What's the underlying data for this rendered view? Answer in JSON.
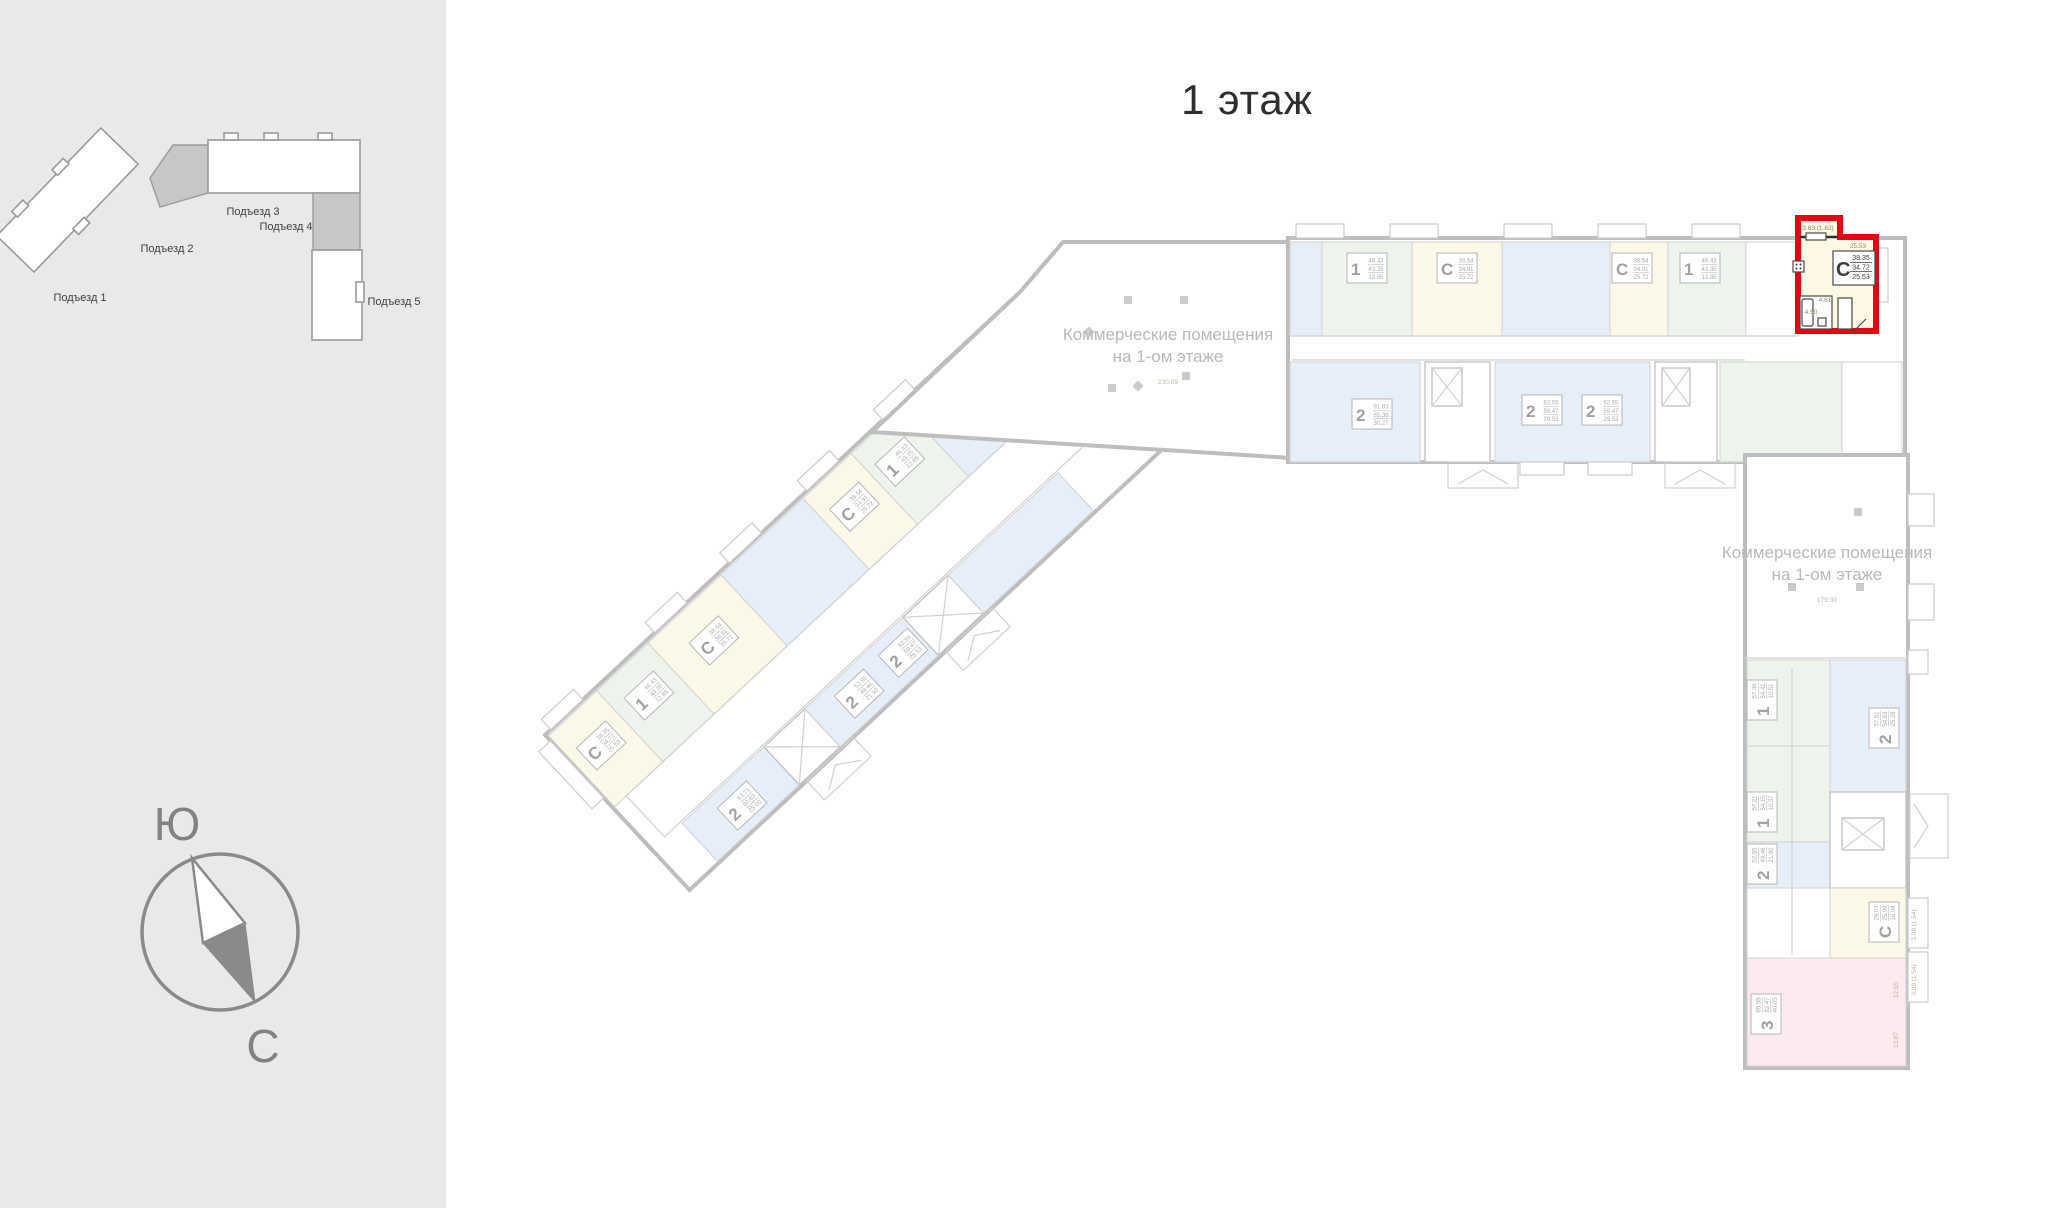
{
  "title": "1 этаж",
  "sidebar": {
    "minimap": {
      "entrances": [
        "Подъезд 1",
        "Подъезд 2",
        "Подъезд 3",
        "Подъезд 4",
        "Подъезд 5"
      ]
    },
    "compass": {
      "south": "Ю",
      "north": "С"
    }
  },
  "plan": {
    "commercial_top": {
      "line1": "Коммерческие помещения",
      "line2": "на 1-ом этаже",
      "area": "230.09"
    },
    "commercial_right": {
      "line1": "Коммерческие помещения",
      "line2": "на 1-ом этаже",
      "area": "179.30"
    },
    "highlighted": {
      "type": "С",
      "total": "38.35",
      "living": "34.72",
      "kitchen": "25.53",
      "balcony": "3.63 (1.82)",
      "room": "25.53",
      "hall": "4.61",
      "bath": "4.50"
    },
    "dims": {
      "v_balcony1": "3.08 (1.54)",
      "v_balcony2": "3.08 (1.54)",
      "pink_room1": "12.95",
      "pink_room2": "13.87"
    },
    "apartments": [
      {
        "type": "1",
        "total": "46.43",
        "living": "43.35",
        "kitchen": "12.85"
      },
      {
        "type": "С",
        "total": "38.54",
        "living": "34.91",
        "kitchen": "25.72"
      },
      {
        "type": "С",
        "total": "38.54",
        "living": "34.91",
        "kitchen": "25.72"
      },
      {
        "type": "1",
        "total": "46.43",
        "living": "43.35",
        "kitchen": "12.85"
      },
      {
        "type": "2",
        "total": "91.83",
        "living": "85.38",
        "kitchen": "30.27"
      },
      {
        "type": "2",
        "total": "62.55",
        "living": "59.47",
        "kitchen": "29.53"
      },
      {
        "type": "2",
        "total": "62.55",
        "living": "59.47",
        "kitchen": "29.53"
      },
      {
        "type": "С",
        "total": "38.35",
        "living": "34.72",
        "kitchen": "25.53"
      },
      {
        "type": "1",
        "total": "46.43",
        "living": "43.35",
        "kitchen": "12.85"
      },
      {
        "type": "С",
        "total": "38.54",
        "living": "34.91",
        "kitchen": "25.72"
      },
      {
        "type": "С",
        "total": "38.54",
        "living": "34.91",
        "kitchen": "25.72"
      },
      {
        "type": "1",
        "total": "46.43",
        "living": "43.35",
        "kitchen": "12.85"
      },
      {
        "type": "2",
        "total": "63.71",
        "living": "60.63",
        "kitchen": "23.00"
      },
      {
        "type": "2",
        "total": "52.55",
        "living": "49.46",
        "kitchen": "21.90"
      },
      {
        "type": "2",
        "total": "62.55",
        "living": "59.47",
        "kitchen": "29.53"
      },
      {
        "type": "1",
        "total": "57.49",
        "living": "54.41",
        "kitchen": "10.51"
      },
      {
        "type": "2",
        "total": "57.51",
        "living": "54.63",
        "kitchen": "25.28"
      },
      {
        "type": "1",
        "total": "57.21",
        "living": "54.15",
        "kitchen": "10.37"
      },
      {
        "type": "2",
        "total": "52.55",
        "living": "49.46",
        "kitchen": "21.90"
      },
      {
        "type": "С",
        "total": "29.07",
        "living": "25.99",
        "kitchen": "16.08"
      },
      {
        "type": "3",
        "total": "85.55",
        "living": "82.47",
        "kitchen": "40.03"
      }
    ]
  },
  "colors": {
    "highlight": "#e30613",
    "studio": "#faf6df",
    "one_room": "#e7f0e4",
    "two_room": "#dde9f6",
    "three_room": "#fbe3e7",
    "sidebar_bg": "#e9e9e9"
  }
}
